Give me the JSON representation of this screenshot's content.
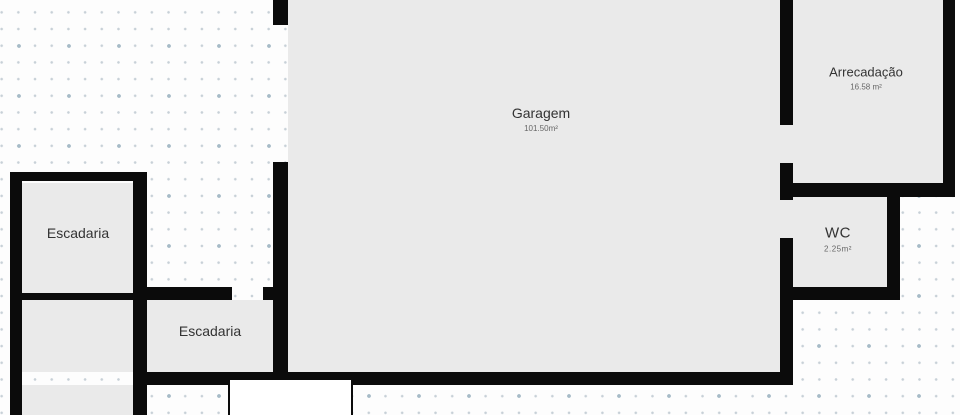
{
  "plan": {
    "type": "floor-plan",
    "level": "garage-basement"
  },
  "colors": {
    "wall": "#0b0b0b",
    "room_fill": "#eaeaea",
    "background": "#fdfdfd",
    "dot_small": "#c7d0d7",
    "dot_accent": "#a6bbc7",
    "label_text": "#333333",
    "sublabel_text": "#666666",
    "opening_fill": "#ffffff"
  },
  "rooms": [
    {
      "id": "garagem",
      "label": "Garagem",
      "area": "101.50m²"
    },
    {
      "id": "arrecadacao",
      "label": "Arrecadação",
      "area": "16.58 m²"
    },
    {
      "id": "wc",
      "label": "WC",
      "area": "2.25m²"
    },
    {
      "id": "escadaria-upper",
      "label": "Escadaria",
      "area": ""
    },
    {
      "id": "escadaria-lower",
      "label": "Escadaria",
      "area": ""
    }
  ]
}
